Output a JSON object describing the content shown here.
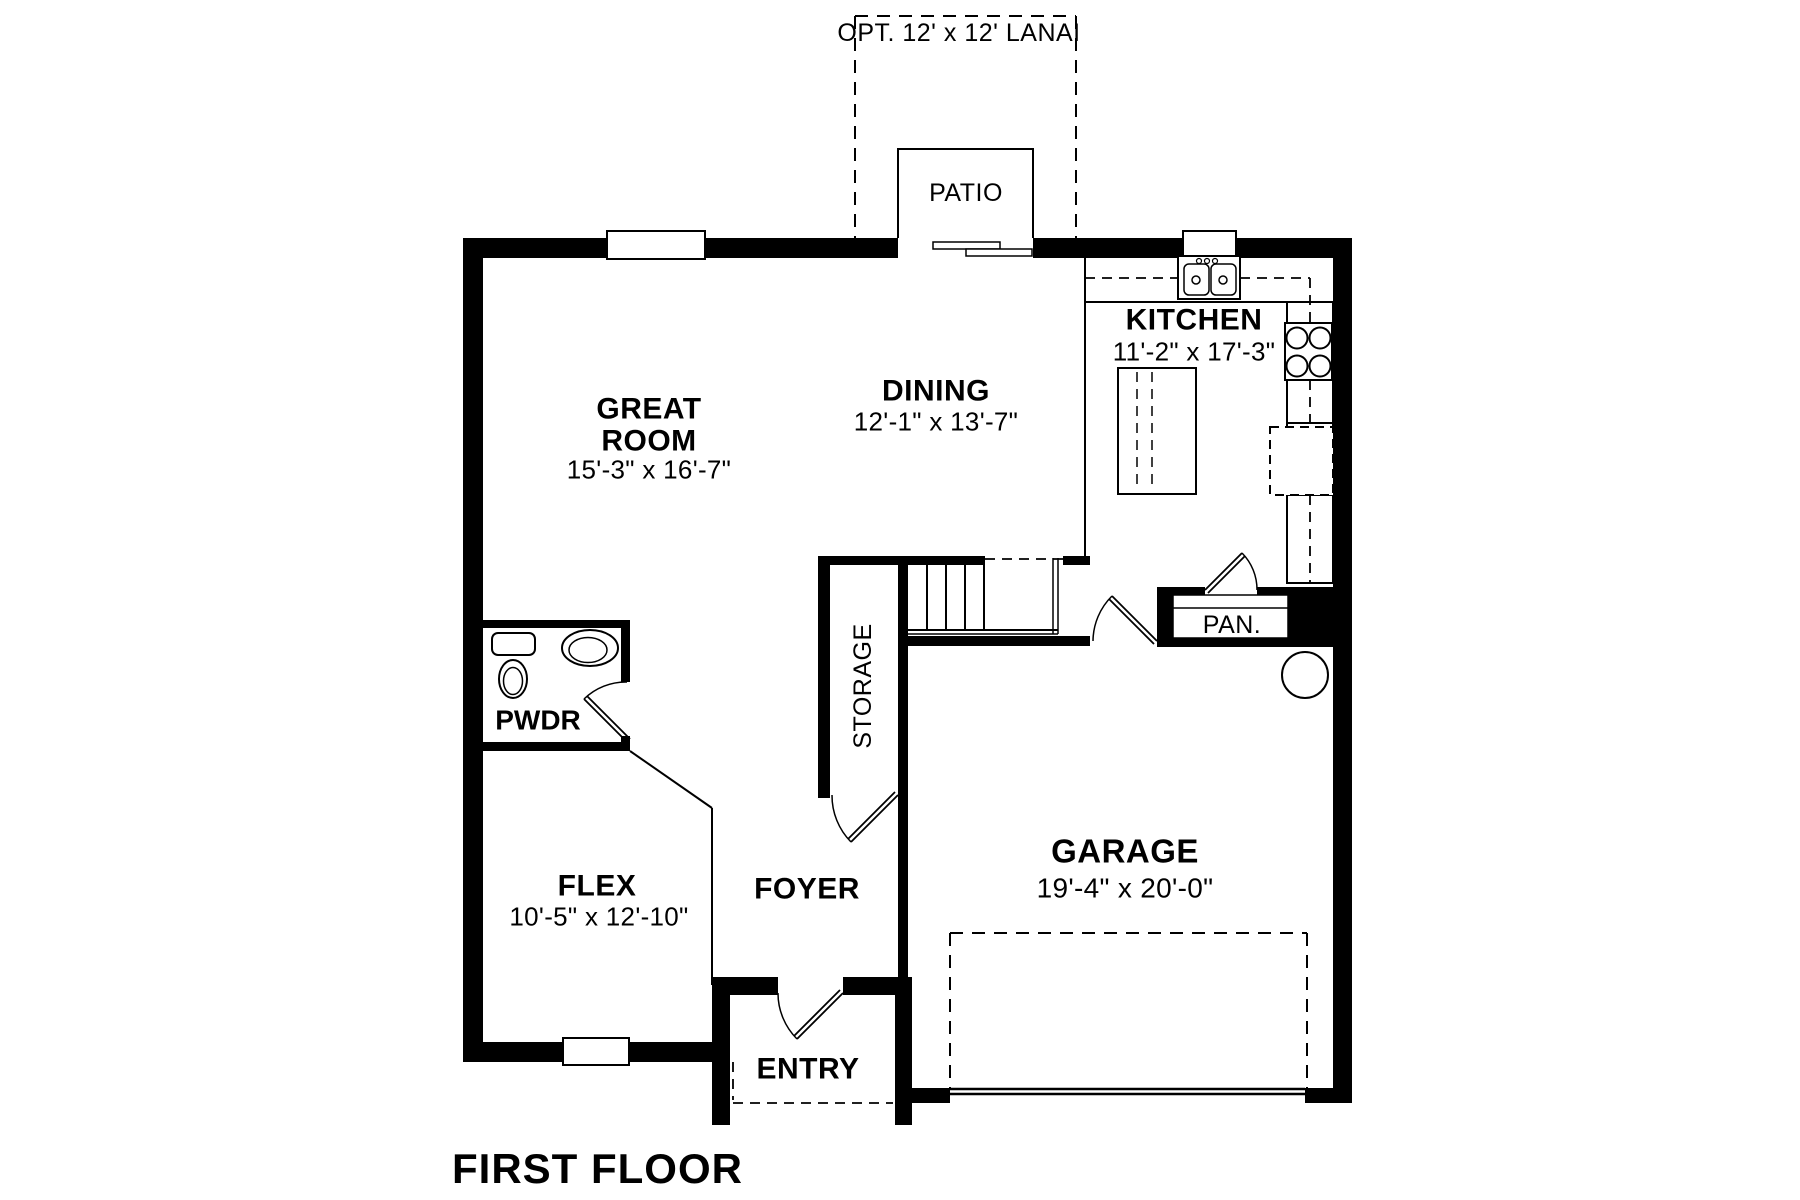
{
  "title": "FIRST FLOOR",
  "outdoor": {
    "lanai": "OPT. 12' x 12' LANAI",
    "patio": "PATIO"
  },
  "rooms": {
    "great_room": {
      "line1": "GREAT",
      "line2": "ROOM",
      "dims": "15'-3\" x 16'-7\""
    },
    "dining": {
      "name": "DINING",
      "dims": "12'-1\" x 13'-7\""
    },
    "kitchen": {
      "name": "KITCHEN",
      "dims": "11'-2\" x 17'-3\""
    },
    "powder": {
      "name": "PWDR"
    },
    "storage": {
      "name": "STORAGE"
    },
    "pantry": {
      "name": "PAN."
    },
    "flex": {
      "name": "FLEX",
      "dims": "10'-5\" x 12'-10\""
    },
    "foyer": {
      "name": "FOYER"
    },
    "entry": {
      "name": "ENTRY"
    },
    "garage": {
      "name": "GARAGE",
      "dims": "19'-4\" x 20'-0\""
    }
  },
  "fixtures": {
    "toilet": "toilet",
    "vanity_sink": "vanity-sink",
    "kitchen_sink": "double-basin-sink",
    "cooktop": "4-burner-cooktop",
    "refrigerator": "refrigerator",
    "island": "kitchen-island",
    "water_heater": "water-heater",
    "stairs": "stairs",
    "garage_door": "garage-door"
  },
  "colors": {
    "wall": "#000000",
    "line": "#000000",
    "background": "#ffffff"
  }
}
